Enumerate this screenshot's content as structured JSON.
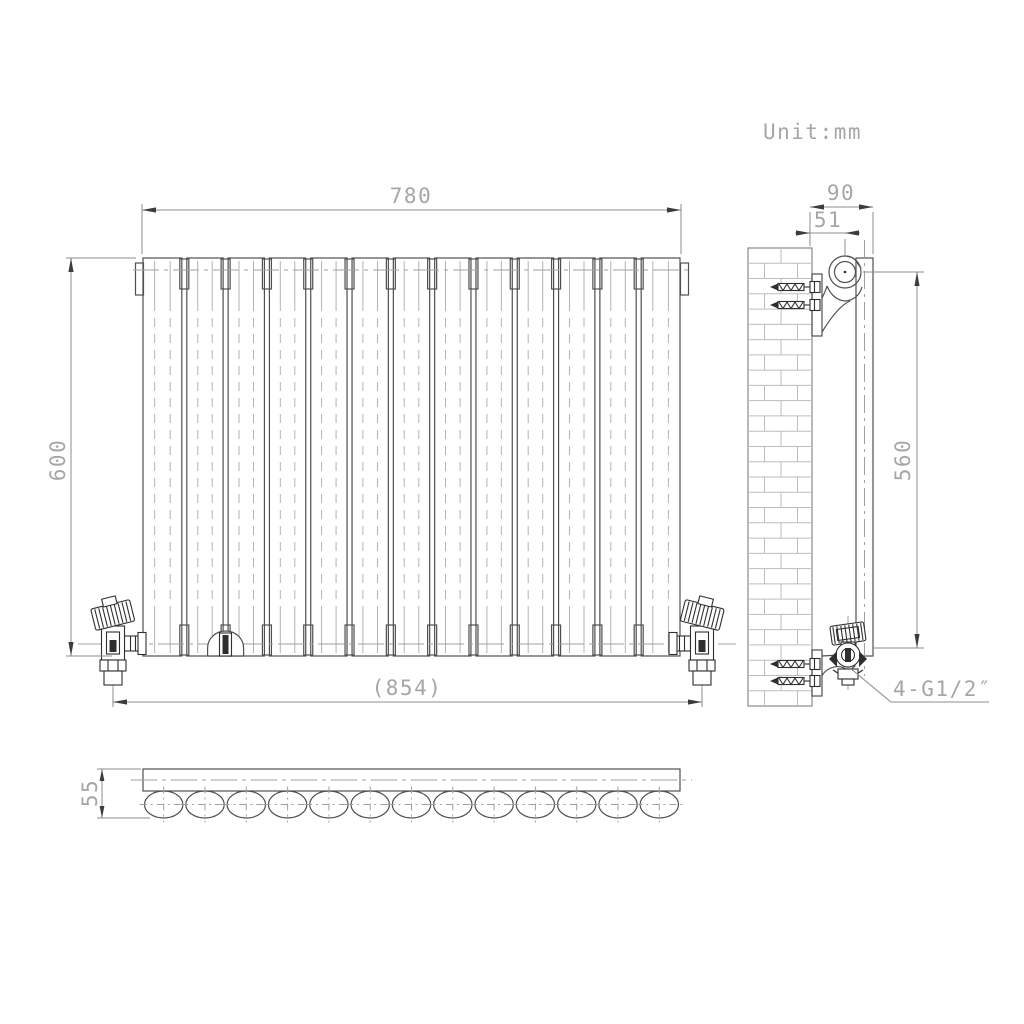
{
  "unit_label": "Unit:mm",
  "drawing": {
    "front_view": {
      "width_dim": "780",
      "height_dim": "600",
      "valve_span_dim": "(854)",
      "panel_count": 13
    },
    "side_view": {
      "depth_dim": "90",
      "bracket_offset_dim": "51",
      "bracket_span_dim": "560",
      "connection_label": "4-G1/2″"
    },
    "bottom_view": {
      "depth_dim": "55",
      "tube_count": 13
    },
    "colors": {
      "outline": "#4f4f4f",
      "dark_detail": "#2f2f2f",
      "dimension_line": "#8c8c8c",
      "dimension_text": "#a6a6a6",
      "centerline": "#a0a0a0",
      "brick_line": "#bdbdbd"
    }
  }
}
